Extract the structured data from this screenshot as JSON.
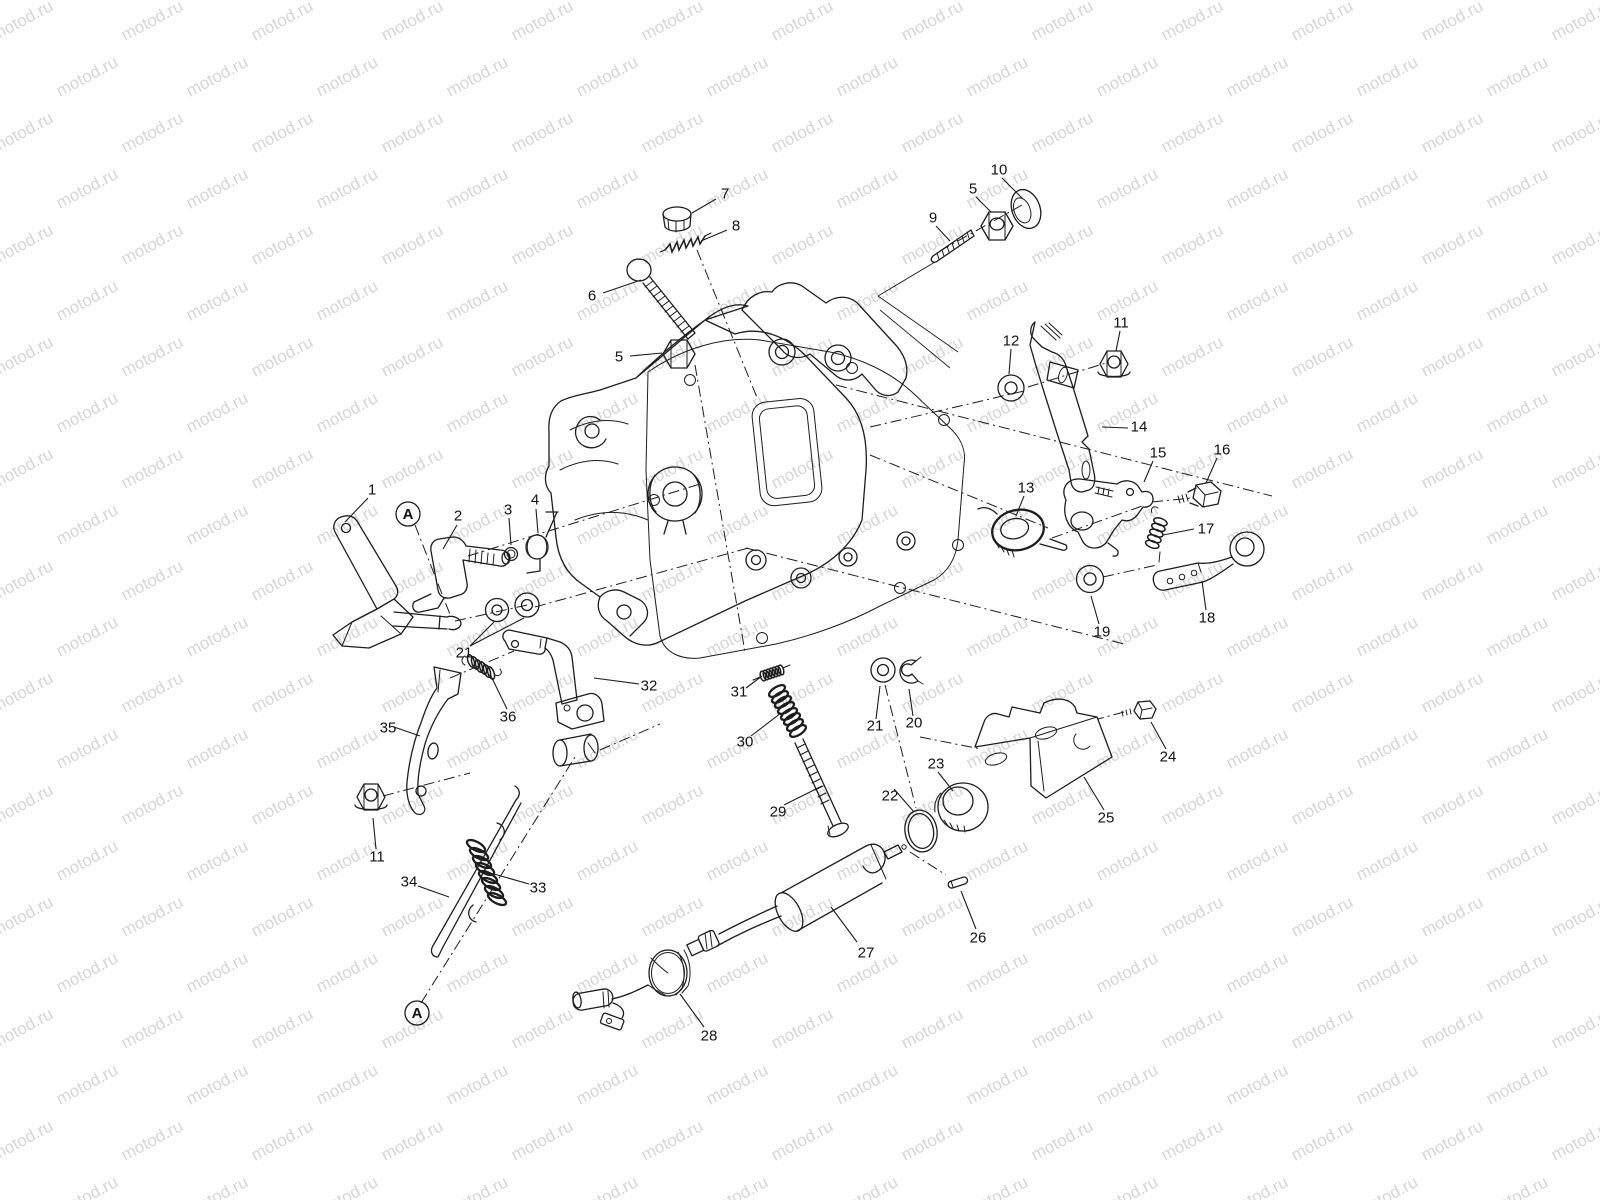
{
  "page": {
    "background": "#ffffff"
  },
  "watermark": {
    "text": "motod.ru",
    "color": "#d6d6d6",
    "font_size": 17,
    "angle_deg": -28,
    "col_spacing": 130,
    "row_spacing": 56,
    "row_offset": 65
  },
  "diagram": {
    "kind": "exploded-parts-diagram",
    "line_color": "#1d1d1d",
    "label_color": "#121212",
    "label_font_size": 15,
    "ref_marker_radius": 12,
    "ref_markers": [
      {
        "text": "A",
        "x": 408,
        "y": 514
      },
      {
        "text": "A",
        "x": 417,
        "y": 1013
      }
    ],
    "labels": [
      {
        "n": "1",
        "x": 372,
        "y": 490,
        "leads": [
          [
            368,
            498,
            345,
            522
          ]
        ]
      },
      {
        "n": "2",
        "x": 458,
        "y": 516,
        "leads": [
          [
            457,
            525,
            443,
            549
          ]
        ]
      },
      {
        "n": "3",
        "x": 508,
        "y": 510,
        "leads": [
          [
            509,
            518,
            511,
            545
          ]
        ]
      },
      {
        "n": "4",
        "x": 535,
        "y": 500,
        "leads": [
          [
            536,
            509,
            538,
            533
          ]
        ]
      },
      {
        "n": "5",
        "x": 619,
        "y": 357,
        "leads": [
          [
            630,
            356,
            662,
            353
          ]
        ]
      },
      {
        "n": "6",
        "x": 592,
        "y": 296,
        "leads": [
          [
            603,
            293,
            641,
            280
          ]
        ]
      },
      {
        "n": "7",
        "x": 725,
        "y": 194,
        "leads": [
          [
            716,
            199,
            692,
            213
          ]
        ]
      },
      {
        "n": "8",
        "x": 736,
        "y": 226,
        "leads": [
          [
            727,
            230,
            701,
            241
          ]
        ]
      },
      {
        "n": "9",
        "x": 933,
        "y": 218,
        "leads": [
          [
            936,
            226,
            950,
            241
          ]
        ]
      },
      {
        "n": "5",
        "x": 973,
        "y": 189,
        "leads": [
          [
            976,
            197,
            991,
            212
          ]
        ]
      },
      {
        "n": "10",
        "x": 999,
        "y": 170,
        "leads": [
          [
            1002,
            178,
            1023,
            199
          ]
        ]
      },
      {
        "n": "11",
        "x": 1121,
        "y": 323,
        "leads": [
          [
            1120,
            331,
            1116,
            351
          ]
        ]
      },
      {
        "n": "12",
        "x": 1011,
        "y": 341,
        "leads": [
          [
            1011,
            349,
            1009,
            374
          ]
        ]
      },
      {
        "n": "13",
        "x": 1026,
        "y": 488,
        "leads": [
          [
            1024,
            496,
            1016,
            516
          ]
        ]
      },
      {
        "n": "14",
        "x": 1139,
        "y": 427,
        "leads": [
          [
            1128,
            428,
            1102,
            427
          ]
        ]
      },
      {
        "n": "15",
        "x": 1158,
        "y": 453,
        "leads": [
          [
            1153,
            461,
            1144,
            482
          ]
        ]
      },
      {
        "n": "16",
        "x": 1222,
        "y": 450,
        "leads": [
          [
            1217,
            458,
            1206,
            483
          ]
        ]
      },
      {
        "n": "17",
        "x": 1206,
        "y": 529,
        "leads": [
          [
            1194,
            529,
            1163,
            535
          ]
        ]
      },
      {
        "n": "18",
        "x": 1207,
        "y": 618,
        "leads": [
          [
            1206,
            610,
            1202,
            581
          ]
        ]
      },
      {
        "n": "19",
        "x": 1102,
        "y": 632,
        "leads": [
          [
            1099,
            624,
            1091,
            596
          ]
        ]
      },
      {
        "n": "20",
        "x": 914,
        "y": 723,
        "leads": [
          [
            913,
            716,
            909,
            689
          ]
        ]
      },
      {
        "n": "21",
        "x": 464,
        "y": 653,
        "leads": [
          [
            470,
            646,
            494,
            622
          ],
          [
            470,
            646,
            524,
            618
          ]
        ]
      },
      {
        "n": "21",
        "x": 875,
        "y": 726,
        "leads": [
          [
            876,
            719,
            880,
            686
          ]
        ]
      },
      {
        "n": "22",
        "x": 890,
        "y": 796,
        "leads": [
          [
            894,
            789,
            914,
            812
          ]
        ]
      },
      {
        "n": "23",
        "x": 936,
        "y": 764,
        "leads": [
          [
            938,
            772,
            953,
            791
          ]
        ]
      },
      {
        "n": "24",
        "x": 1168,
        "y": 757,
        "leads": [
          [
            1166,
            749,
            1151,
            722
          ]
        ]
      },
      {
        "n": "25",
        "x": 1106,
        "y": 818,
        "leads": [
          [
            1104,
            810,
            1084,
            777
          ]
        ]
      },
      {
        "n": "26",
        "x": 978,
        "y": 938,
        "leads": [
          [
            976,
            929,
            961,
            891
          ]
        ]
      },
      {
        "n": "27",
        "x": 866,
        "y": 953,
        "leads": [
          [
            857,
            942,
            831,
            907
          ]
        ]
      },
      {
        "n": "28",
        "x": 709,
        "y": 1036,
        "leads": [
          [
            704,
            1027,
            680,
            994
          ]
        ]
      },
      {
        "n": "29",
        "x": 778,
        "y": 812,
        "leads": [
          [
            784,
            805,
            822,
            786
          ]
        ]
      },
      {
        "n": "30",
        "x": 745,
        "y": 742,
        "leads": [
          [
            751,
            736,
            781,
            713
          ]
        ]
      },
      {
        "n": "31",
        "x": 739,
        "y": 692,
        "leads": [
          [
            746,
            688,
            762,
            676
          ]
        ]
      },
      {
        "n": "32",
        "x": 649,
        "y": 686,
        "leads": [
          [
            639,
            684,
            594,
            678
          ]
        ]
      },
      {
        "n": "33",
        "x": 538,
        "y": 888,
        "leads": [
          [
            529,
            884,
            494,
            874
          ]
        ]
      },
      {
        "n": "34",
        "x": 409,
        "y": 882,
        "leads": [
          [
            418,
            886,
            449,
            897
          ]
        ]
      },
      {
        "n": "35",
        "x": 388,
        "y": 728,
        "leads": [
          [
            394,
            727,
            420,
            736
          ]
        ]
      },
      {
        "n": "36",
        "x": 508,
        "y": 717,
        "leads": [
          [
            507,
            709,
            490,
            674
          ]
        ]
      },
      {
        "n": "11",
        "x": 377,
        "y": 857,
        "leads": [
          [
            376,
            849,
            373,
            818
          ]
        ]
      }
    ],
    "dash_lines": [
      [
        695,
        365,
        745,
        652
      ],
      [
        697,
        250,
        758,
        400
      ],
      [
        1022,
        205,
        940,
        251
      ],
      [
        1028,
        387,
        1106,
        363
      ],
      [
        1024,
        391,
        866,
        428
      ],
      [
        836,
        385,
        1272,
        496
      ],
      [
        746,
        548,
        1124,
        644
      ],
      [
        870,
        455,
        1048,
        528
      ],
      [
        1052,
        538,
        1145,
        505
      ],
      [
        1152,
        502,
        1192,
        498
      ],
      [
        1103,
        577,
        1157,
        565
      ],
      [
        468,
        556,
        700,
        484
      ],
      [
        455,
        621,
        532,
        604
      ],
      [
        535,
        607,
        752,
        547
      ],
      [
        415,
        525,
        451,
        617
      ],
      [
        421,
        1003,
        575,
        757
      ],
      [
        383,
        796,
        470,
        773
      ],
      [
        450,
        678,
        514,
        651
      ],
      [
        600,
        750,
        660,
        724
      ],
      [
        885,
        685,
        916,
        808
      ],
      [
        920,
        737,
        981,
        749
      ],
      [
        1124,
        712,
        1098,
        719
      ],
      [
        910,
        852,
        946,
        875
      ]
    ],
    "pointer_lines": [
      [
        935,
        262,
        878,
        296
      ],
      [
        878,
        296,
        958,
        352
      ],
      [
        880,
        310,
        950,
        368
      ]
    ]
  }
}
